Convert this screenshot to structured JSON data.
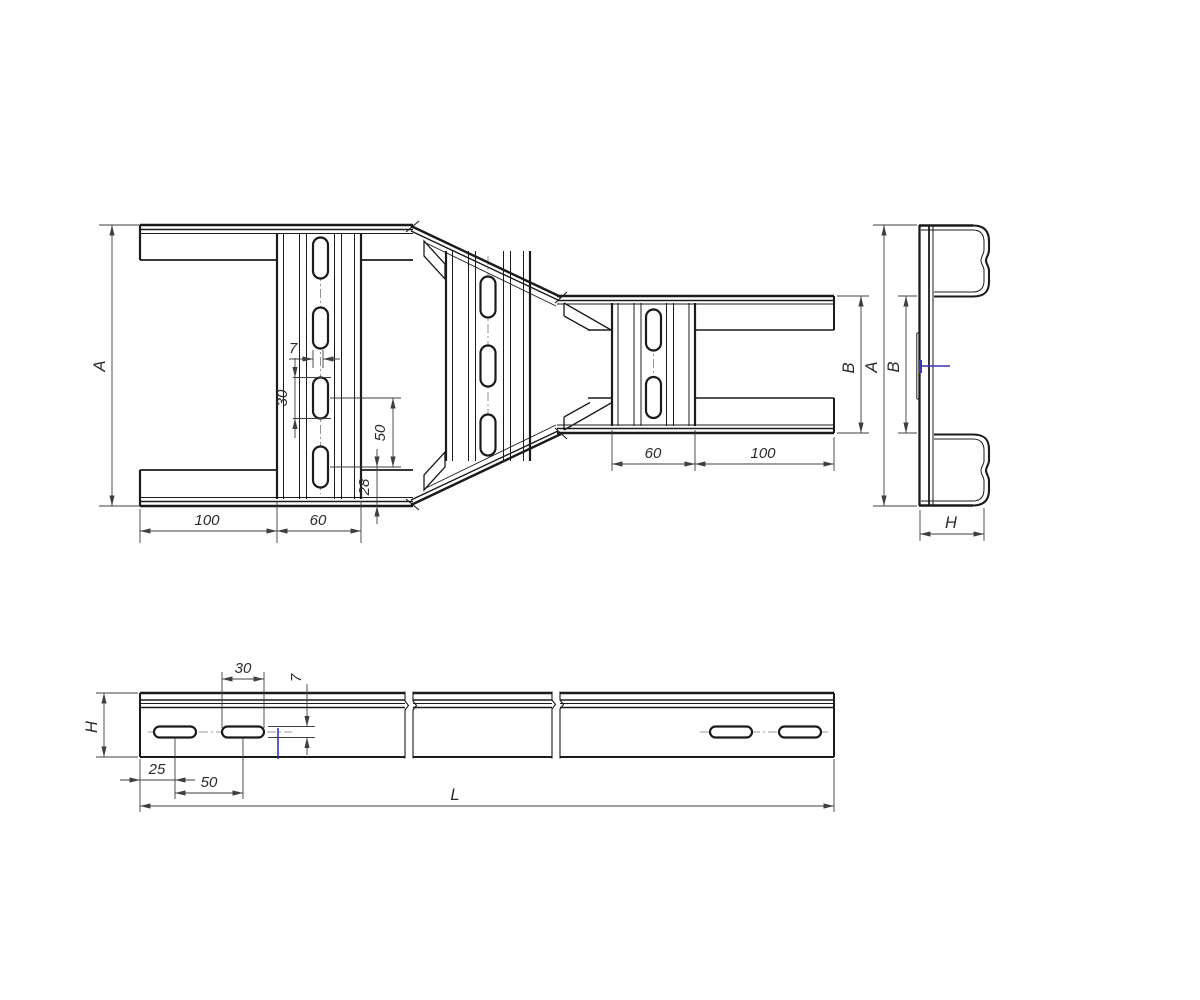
{
  "drawing": {
    "type": "cable-ladder-reducer-technical-drawing",
    "colors": {
      "line": "#1b1b1b",
      "dim_line": "#3f3f3f",
      "accent_blue": "#3636b8",
      "background": "#ffffff"
    },
    "labels": {
      "plan": {
        "width_a": "A",
        "offset_left": "100",
        "rung_left": "60",
        "slot_w": "7",
        "slot_len": "30",
        "slot_pitch": "50",
        "edge_gap": "28",
        "rung_right": "60",
        "offset_right": "100",
        "width_b": "B"
      },
      "end": {
        "width_a": "A",
        "width_b": "B",
        "height_h": "H"
      },
      "side": {
        "height_h": "H",
        "slot_len": "30",
        "slot_w": "7",
        "end_offset": "25",
        "slot_pitch": "50",
        "length_l": "L"
      }
    }
  }
}
